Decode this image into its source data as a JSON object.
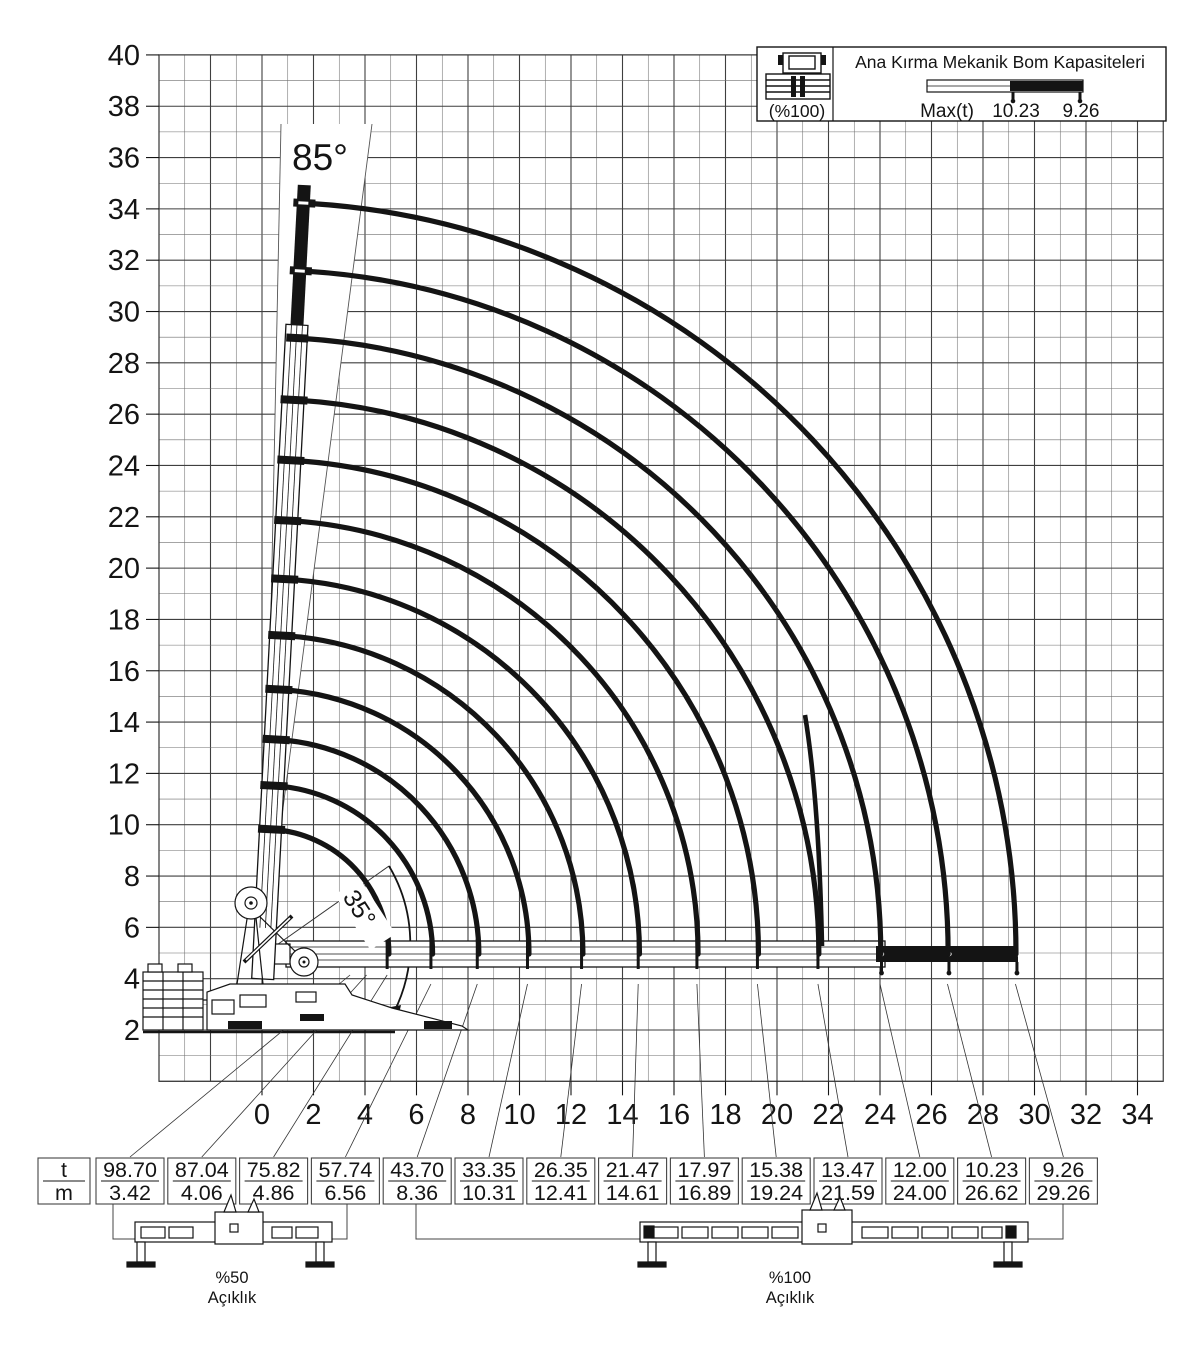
{
  "page": {
    "background": "#ffffff",
    "ink": "#141414",
    "grid_major": "#3f3f3f",
    "grid_minor": "#6e6e6e"
  },
  "legend": {
    "title": "Ana Kırma Mekanik Bom Kapasiteleri",
    "outrigger_mode": "(%100)",
    "max_label": "Max(t)",
    "max_values": [
      "10.23",
      "9.26"
    ]
  },
  "chart_data": {
    "type": "line",
    "title": "Ana Kırma Mekanik Bom Kapasiteleri",
    "xlabel": "reach (m)",
    "ylabel": "height (m)",
    "xlim": [
      -4,
      35
    ],
    "ylim": [
      0,
      40
    ],
    "grid": "1 m squares",
    "x_ticks": [
      0,
      2,
      4,
      6,
      8,
      10,
      12,
      14,
      16,
      18,
      20,
      22,
      24,
      26,
      28,
      30,
      32,
      34
    ],
    "y_ticks": [
      2,
      4,
      6,
      8,
      10,
      12,
      14,
      16,
      18,
      20,
      22,
      24,
      26,
      28,
      30,
      32,
      34,
      36,
      38,
      40
    ],
    "boom_angle_max_label": "85°",
    "boom_angle_min_label": "35°",
    "series": [
      {
        "name": "Max capacity (t) at reach (m)",
        "points": [
          {
            "capacity_t": 98.7,
            "reach_m": 3.42
          },
          {
            "capacity_t": 87.04,
            "reach_m": 4.06
          },
          {
            "capacity_t": 75.82,
            "reach_m": 4.86
          },
          {
            "capacity_t": 57.74,
            "reach_m": 6.56
          },
          {
            "capacity_t": 43.7,
            "reach_m": 8.36
          },
          {
            "capacity_t": 33.35,
            "reach_m": 10.31
          },
          {
            "capacity_t": 26.35,
            "reach_m": 12.41
          },
          {
            "capacity_t": 21.47,
            "reach_m": 14.61
          },
          {
            "capacity_t": 17.97,
            "reach_m": 16.89
          },
          {
            "capacity_t": 15.38,
            "reach_m": 19.24
          },
          {
            "capacity_t": 13.47,
            "reach_m": 21.59
          },
          {
            "capacity_t": 12.0,
            "reach_m": 24.0
          },
          {
            "capacity_t": 10.23,
            "reach_m": 26.62
          },
          {
            "capacity_t": 9.26,
            "reach_m": 29.26
          }
        ]
      }
    ],
    "arc_reaches_m": [
      4.86,
      6.56,
      8.36,
      10.31,
      12.41,
      14.61,
      16.89,
      19.24,
      21.59,
      24.0,
      26.62,
      29.26
    ]
  },
  "table": {
    "header": {
      "top": "t",
      "bottom": "m"
    },
    "cells": [
      {
        "t": "98.70",
        "m": "3.42"
      },
      {
        "t": "87.04",
        "m": "4.06"
      },
      {
        "t": "75.82",
        "m": "4.86"
      },
      {
        "t": "57.74",
        "m": "6.56"
      },
      {
        "t": "43.70",
        "m": "8.36"
      },
      {
        "t": "33.35",
        "m": "10.31"
      },
      {
        "t": "26.35",
        "m": "12.41"
      },
      {
        "t": "21.47",
        "m": "14.61"
      },
      {
        "t": "17.97",
        "m": "16.89"
      },
      {
        "t": "15.38",
        "m": "19.24"
      },
      {
        "t": "13.47",
        "m": "21.59"
      },
      {
        "t": "12.00",
        "m": "24.00"
      },
      {
        "t": "10.23",
        "m": "26.62"
      },
      {
        "t": "9.26",
        "m": "29.26"
      }
    ]
  },
  "outriggers": {
    "left": {
      "percent": "%50",
      "label": "Açıklık"
    },
    "right": {
      "percent": "%100",
      "label": "Açıklık"
    }
  }
}
